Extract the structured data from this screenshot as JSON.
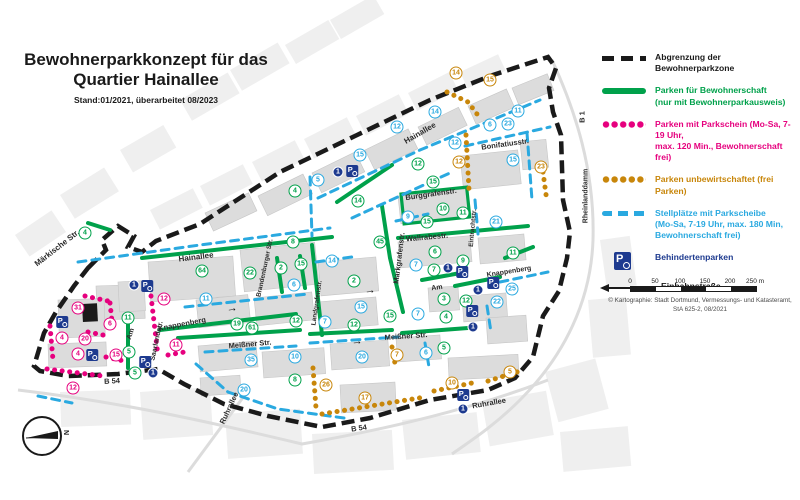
{
  "title": {
    "line1": "Bewohnerparkkonzept für das",
    "line2": "Quartier Hainallee",
    "stand": "Stand:01/2021, überarbeitet 08/2023"
  },
  "legend": {
    "items": [
      {
        "type": "dashblack",
        "color": "#1a1a1a",
        "lines": [
          "Abgrenzung der Bewohnerparkzone"
        ]
      },
      {
        "type": "linegreen",
        "color": "#00A14B",
        "lines": [
          "Parken für Bewohnerschaft",
          "(nur mit Bewohnerparkausweis)"
        ]
      },
      {
        "type": "dotspink",
        "color": "#E6007E",
        "lines": [
          "Parken mit Parkschein  (Mo-Sa, 7-19 Uhr,",
          "max. 120 Min., Bewohnerschaft frei)"
        ]
      },
      {
        "type": "dotsorange",
        "color": "#C8860A",
        "lines": [
          "Parken unbewirtschaftet (frei Parken)"
        ]
      },
      {
        "type": "dashblue",
        "color": "#2AA9E0",
        "lines": [
          "Stellplätze mit Parkscheibe",
          "(Mo-Sa, 7-19 Uhr, max. 180 Min,",
          "Bewohnerschaft frei)"
        ]
      },
      {
        "type": "picon",
        "color": "#1D3A8F",
        "lines": [
          "Behindertenparken"
        ]
      },
      {
        "type": "parrow",
        "color": "#1a1a1a",
        "lines": [
          "Einbahnstraße"
        ]
      }
    ]
  },
  "scale": {
    "ticks": [
      "0",
      "50",
      "100",
      "150",
      "200",
      "250 m"
    ]
  },
  "copyright": {
    "line1": "© Kartographie: Stadt Dortmund, Vermessungs- und Katasteramt,",
    "line2": "StA 625-2, 08/2021"
  },
  "map": {
    "compass_label": "N",
    "street_labels": [
      {
        "t": "Märkische Str.",
        "x": 57,
        "y": 248,
        "r": -38,
        "s": 8
      },
      {
        "t": "Hainallee",
        "x": 196,
        "y": 257,
        "r": -7,
        "s": 8
      },
      {
        "t": "Hainallee",
        "x": 420,
        "y": 133,
        "r": -30,
        "s": 8
      },
      {
        "t": "Bonifatiusstr.",
        "x": 505,
        "y": 144,
        "r": -8,
        "s": 7.5
      },
      {
        "t": "Burggrafenstr.",
        "x": 431,
        "y": 194,
        "r": -8,
        "s": 7.5
      },
      {
        "t": "Wallrabestr.",
        "x": 427,
        "y": 237,
        "r": -5,
        "s": 7.5
      },
      {
        "t": "Markgrafenstr.",
        "x": 399,
        "y": 258,
        "r": -83,
        "s": 7.5
      },
      {
        "t": "Brandenburger Str.",
        "x": 265,
        "y": 268,
        "r": -78,
        "s": 6.5
      },
      {
        "t": "Landgrafenstr.",
        "x": 317,
        "y": 303,
        "r": -82,
        "s": 6.5
      },
      {
        "t": "Eintrachtstr.",
        "x": 473,
        "y": 228,
        "r": -85,
        "s": 6.5
      },
      {
        "t": "Knappenberg",
        "x": 182,
        "y": 324,
        "r": -11,
        "s": 7.5
      },
      {
        "t": "Knappenberg",
        "x": 509,
        "y": 272,
        "r": -9,
        "s": 7
      },
      {
        "t": "Saarlandstr.",
        "x": 157,
        "y": 341,
        "r": -78,
        "s": 7
      },
      {
        "t": "Meißner Str.",
        "x": 250,
        "y": 344,
        "r": -5,
        "s": 7.5
      },
      {
        "t": "Meißner Str.",
        "x": 406,
        "y": 336,
        "r": -4,
        "s": 7.5
      },
      {
        "t": "Am",
        "x": 131,
        "y": 334,
        "r": -72,
        "s": 7
      },
      {
        "t": "Am",
        "x": 437,
        "y": 288,
        "r": -8,
        "s": 7
      },
      {
        "t": "B 54",
        "x": 112,
        "y": 381,
        "r": -3,
        "s": 7.5
      },
      {
        "t": "B 54",
        "x": 359,
        "y": 428,
        "r": -8,
        "s": 7.5
      },
      {
        "t": "B 1",
        "x": 582,
        "y": 117,
        "r": -90,
        "s": 7.5
      },
      {
        "t": "Rheinlanddamm",
        "x": 586,
        "y": 196,
        "r": -90,
        "s": 7
      },
      {
        "t": "Ruhrallee",
        "x": 229,
        "y": 408,
        "r": -65,
        "s": 7.5
      },
      {
        "t": "Ruhrallee",
        "x": 489,
        "y": 403,
        "r": -10,
        "s": 7.5
      }
    ],
    "markers": [
      [
        85,
        233,
        "g",
        "4"
      ],
      [
        295,
        191,
        "g",
        "4"
      ],
      [
        358,
        201,
        "g",
        "14"
      ],
      [
        418,
        164,
        "g",
        "12"
      ],
      [
        433,
        182,
        "g",
        "15"
      ],
      [
        380,
        242,
        "g",
        "45"
      ],
      [
        354,
        281,
        "g",
        "2"
      ],
      [
        202,
        271,
        "g",
        "64"
      ],
      [
        250,
        273,
        "g",
        "22"
      ],
      [
        281,
        268,
        "g",
        "2"
      ],
      [
        301,
        264,
        "g",
        "15"
      ],
      [
        293,
        242,
        "g",
        "8"
      ],
      [
        427,
        222,
        "g",
        "15"
      ],
      [
        443,
        209,
        "g",
        "10"
      ],
      [
        463,
        213,
        "g",
        "11"
      ],
      [
        435,
        252,
        "g",
        "6"
      ],
      [
        434,
        270,
        "g",
        "7"
      ],
      [
        463,
        261,
        "g",
        "9"
      ],
      [
        444,
        299,
        "g",
        "3"
      ],
      [
        466,
        301,
        "g",
        "12"
      ],
      [
        446,
        317,
        "g",
        "4"
      ],
      [
        513,
        253,
        "g",
        "11"
      ],
      [
        390,
        316,
        "g",
        "15"
      ],
      [
        354,
        325,
        "g",
        "12"
      ],
      [
        296,
        321,
        "g",
        "12"
      ],
      [
        237,
        324,
        "g",
        "19"
      ],
      [
        252,
        328,
        "g",
        "61"
      ],
      [
        295,
        380,
        "g",
        "8"
      ],
      [
        444,
        348,
        "g",
        "5"
      ],
      [
        129,
        352,
        "g",
        "5"
      ],
      [
        135,
        373,
        "g",
        "5"
      ],
      [
        128,
        318,
        "g",
        "11"
      ],
      [
        435,
        112,
        "b",
        "14"
      ],
      [
        397,
        127,
        "b",
        "12"
      ],
      [
        360,
        155,
        "b",
        "15"
      ],
      [
        318,
        180,
        "b",
        "5"
      ],
      [
        408,
        217,
        "b",
        "9"
      ],
      [
        490,
        125,
        "b",
        "6"
      ],
      [
        508,
        124,
        "b",
        "23"
      ],
      [
        518,
        111,
        "b",
        "11"
      ],
      [
        455,
        143,
        "b",
        "12"
      ],
      [
        513,
        160,
        "b",
        "15"
      ],
      [
        332,
        261,
        "b",
        "14"
      ],
      [
        361,
        307,
        "b",
        "15"
      ],
      [
        294,
        285,
        "b",
        "6"
      ],
      [
        206,
        299,
        "b",
        "11"
      ],
      [
        416,
        265,
        "b",
        "7"
      ],
      [
        496,
        222,
        "b",
        "21"
      ],
      [
        497,
        302,
        "b",
        "22"
      ],
      [
        512,
        289,
        "b",
        "25"
      ],
      [
        325,
        322,
        "b",
        "7"
      ],
      [
        418,
        314,
        "b",
        "7"
      ],
      [
        295,
        357,
        "b",
        "10"
      ],
      [
        362,
        357,
        "b",
        "20"
      ],
      [
        426,
        353,
        "b",
        "6"
      ],
      [
        251,
        360,
        "b",
        "35"
      ],
      [
        244,
        390,
        "b",
        "20"
      ],
      [
        456,
        73,
        "o",
        "14"
      ],
      [
        490,
        80,
        "o",
        "15"
      ],
      [
        459,
        162,
        "o",
        "12"
      ],
      [
        541,
        167,
        "o",
        "23"
      ],
      [
        397,
        355,
        "o",
        "7"
      ],
      [
        326,
        385,
        "o",
        "26"
      ],
      [
        365,
        398,
        "o",
        "17"
      ],
      [
        452,
        383,
        "o",
        "10"
      ],
      [
        510,
        372,
        "o",
        "5"
      ],
      [
        78,
        308,
        "p",
        "31"
      ],
      [
        164,
        299,
        "p",
        "12"
      ],
      [
        110,
        324,
        "p",
        "6"
      ],
      [
        62,
        338,
        "p",
        "4"
      ],
      [
        85,
        339,
        "p",
        "20"
      ],
      [
        78,
        354,
        "p",
        "4"
      ],
      [
        116,
        355,
        "p",
        "15"
      ],
      [
        73,
        388,
        "p",
        "12"
      ],
      [
        176,
        345,
        "p",
        "11"
      ],
      [
        338,
        172,
        "n",
        "1"
      ],
      [
        134,
        285,
        "n",
        "1"
      ],
      [
        448,
        268,
        "n",
        "1"
      ],
      [
        478,
        290,
        "n",
        "1"
      ],
      [
        473,
        327,
        "n",
        "1"
      ],
      [
        463,
        409,
        "n",
        "1"
      ],
      [
        153,
        373,
        "n",
        "1"
      ]
    ],
    "p_label": "P",
    "p_icons": [
      [
        352,
        171
      ],
      [
        147,
        286
      ],
      [
        462,
        272
      ],
      [
        493,
        283
      ],
      [
        472,
        311
      ],
      [
        463,
        395
      ],
      [
        145,
        362
      ],
      [
        92,
        355
      ],
      [
        62,
        322
      ]
    ],
    "arrow_glyph": "→",
    "arrows": [
      [
        232,
        309,
        -8
      ],
      [
        370,
        291,
        -5
      ],
      [
        357,
        342,
        -5
      ]
    ]
  }
}
